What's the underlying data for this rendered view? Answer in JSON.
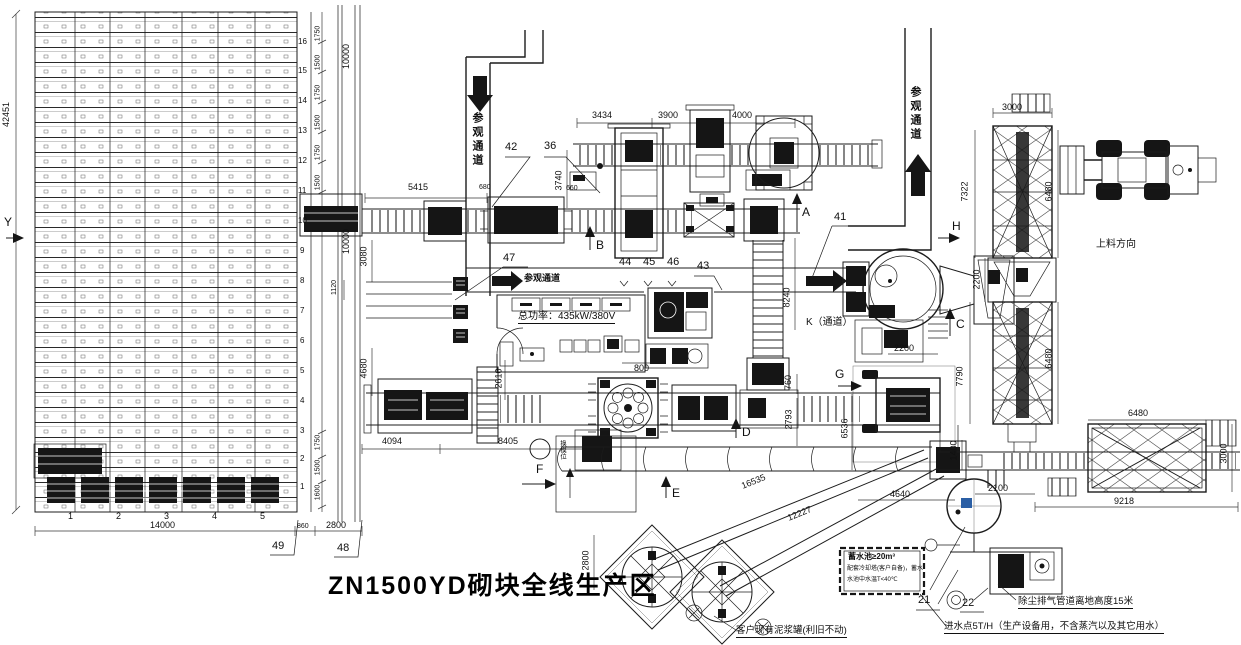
{
  "texts": {
    "title": "ZN1500YD砌块全线生产区",
    "visit_v1": "参观通道",
    "visit_v2": "参观通道",
    "visit_h": "参观通道",
    "k_pass": "K（通道）",
    "loading_dir": "上料方向",
    "power": "总功率：435kW/380V",
    "mold_pos": "换模位",
    "slurry_note": "客户现有泥浆罐(利旧不动)",
    "dust_note": "除尘排气管道离地高度15米",
    "water_note": "进水点5T/H（生产设备用，不含蒸汽以及其它用水）",
    "pool_l1": "蓄水池≥20m³",
    "pool_l2": "配套冷却塔(客户自备)，蓄水",
    "pool_l3": "水池中水温T<40℃"
  },
  "letters": {
    "A": "A",
    "B": "B",
    "C": "C",
    "D": "D",
    "E": "E",
    "F": "F",
    "G": "G",
    "H": "H",
    "Y": "Y"
  },
  "callouts": {
    "n21": "21",
    "n22": "22",
    "n36": "36",
    "n41": "41",
    "n42": "42",
    "n43": "43",
    "n44": "44",
    "n45": "45",
    "n46": "46",
    "n47": "47",
    "n48": "48",
    "n49": "49"
  },
  "dims": {
    "rack_h": "42451",
    "corr1": "10000",
    "corr2": "10000",
    "d5415": "5415",
    "d680": "680",
    "d660": "660",
    "d3740": "3740",
    "d3434": "3434",
    "d3900": "3900",
    "d4000": "4000",
    "d3080": "3080",
    "d1120": "1120",
    "d3000_top": "3000",
    "d7322": "7322",
    "d6480_u": "6480",
    "d2200_v": "2200",
    "d2200_h": "2200",
    "d7790": "7790",
    "d6480_l": "6480",
    "d8240": "8240",
    "d4680": "4680",
    "d2610": "2610",
    "d4094": "4094",
    "d8405": "8405",
    "d800": "800",
    "d760": "760",
    "d2793": "2793",
    "d6536": "6536",
    "d16535": "16535",
    "d12227": "12227",
    "d2800_t": "2800",
    "d1400": "1400",
    "d2100": "2100",
    "d4640": "4640",
    "d9218": "9218",
    "d6480_b": "6480",
    "d3000_r": "3000",
    "d14000": "14000",
    "d860": "860",
    "d2800_b": "2800",
    "pitch": [
      "1750",
      "1500",
      "1750",
      "1500",
      "1750",
      "1500"
    ],
    "pitch_b": [
      "1750",
      "1500",
      "1600"
    ]
  },
  "rows": {
    "side": [
      "16",
      "15",
      "14",
      "13",
      "12",
      "11",
      "10",
      "9",
      "8",
      "7",
      "6",
      "5",
      "4",
      "3",
      "2",
      "1"
    ],
    "bottom": [
      "1",
      "2",
      "3",
      "4",
      "5"
    ]
  },
  "colors": {
    "ink": "#1c1c1c",
    "accent_blue": "#2b5fa5"
  }
}
